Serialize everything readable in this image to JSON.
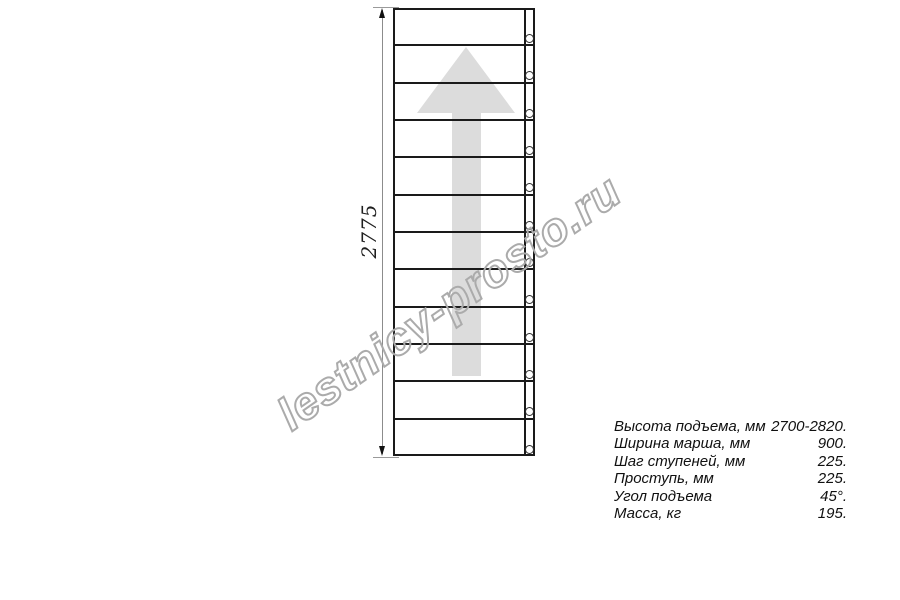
{
  "watermark": {
    "text": "lestnicy-prosto.ru",
    "color": "#ababab",
    "rotation_deg": -35
  },
  "drawing": {
    "type": "staircase-plan-technical-drawing",
    "steps": 12,
    "holes": 12,
    "dimension_label": "2775",
    "direction_arrow": "up-arrow",
    "colors": {
      "line": "#1a1a1a",
      "arrow_fill": "#dcdcdc",
      "dimension_line": "#8c8c8c"
    }
  },
  "specs": {
    "rows": [
      {
        "label": "Высота подъема, мм",
        "value": "2700-2820."
      },
      {
        "label": "Ширина марша, мм",
        "value": "900."
      },
      {
        "label": "Шаг ступеней, мм",
        "value": "225."
      },
      {
        "label": "Проступь, мм",
        "value": "225."
      },
      {
        "label": "Угол подъема",
        "value": "45°."
      },
      {
        "label": "Масса, кг",
        "value": "195."
      }
    ]
  }
}
